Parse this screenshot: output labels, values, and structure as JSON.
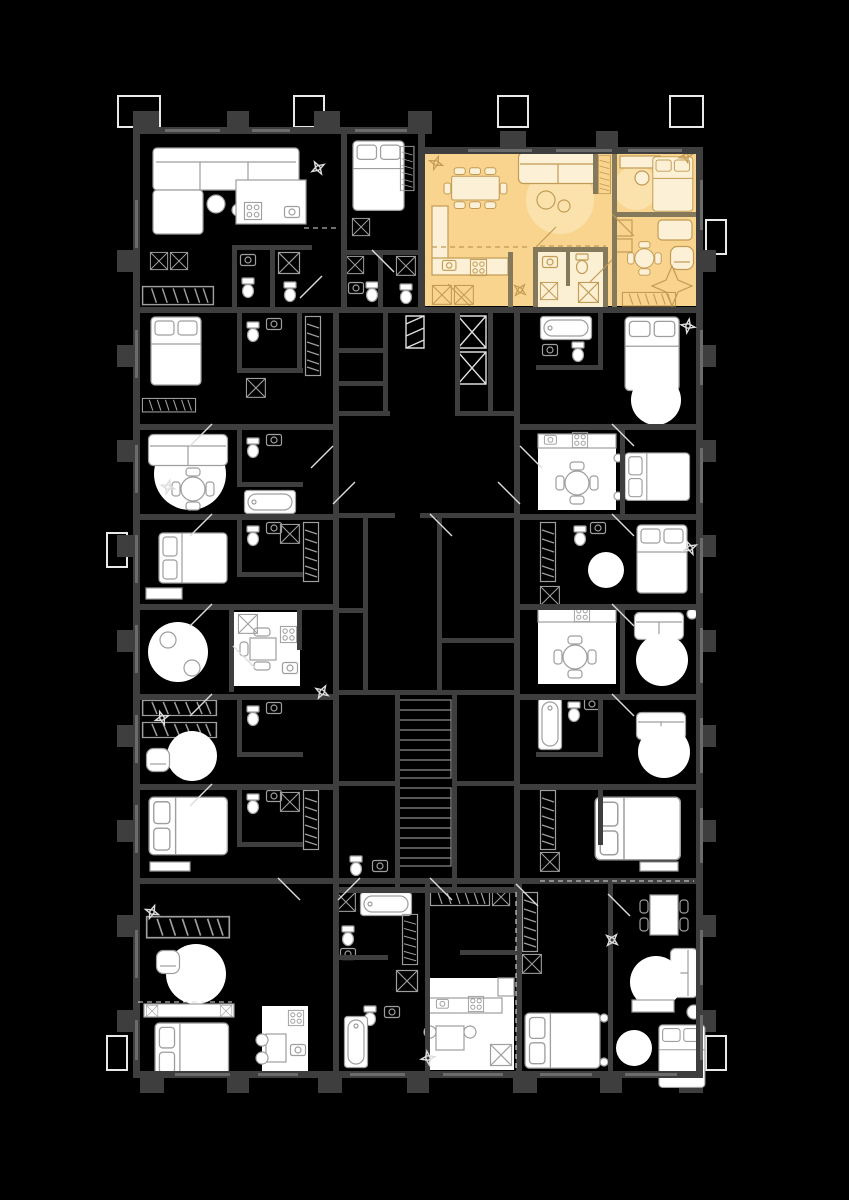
{
  "title": "residential-tower-floor-plan",
  "colors": {
    "bg": "#000000",
    "wall": "#3E3E3E",
    "hl_wall": "#85795B",
    "window": "#6B6B6B",
    "slab": "#E9E9E9",
    "furn_fill": "#FFFFFF",
    "furn_line": "#9E9E9E",
    "bright": "#DEDEDE",
    "stair": "#8C8C8C",
    "hl_floor": "#F9D48F",
    "hl_floor_light": "#FCF0D4",
    "hl_rug": "#FBE2AC",
    "hl_line": "#C29B54",
    "hl_furn_fill": "#FCF1D6"
  },
  "plan": {
    "highlighted_unit": {
      "name": "highlighted-apartment",
      "position": "top-right",
      "rooms": [
        "living-dining",
        "kitchen",
        "bedroom",
        "study",
        "bathroom",
        "hall"
      ],
      "floor_color": "#F9D48F"
    },
    "core": {
      "elevators": 2,
      "stair_flights": 2
    },
    "perimeter_units": {
      "top": 2,
      "left": 6,
      "right": 6,
      "bottom": 4
    }
  }
}
